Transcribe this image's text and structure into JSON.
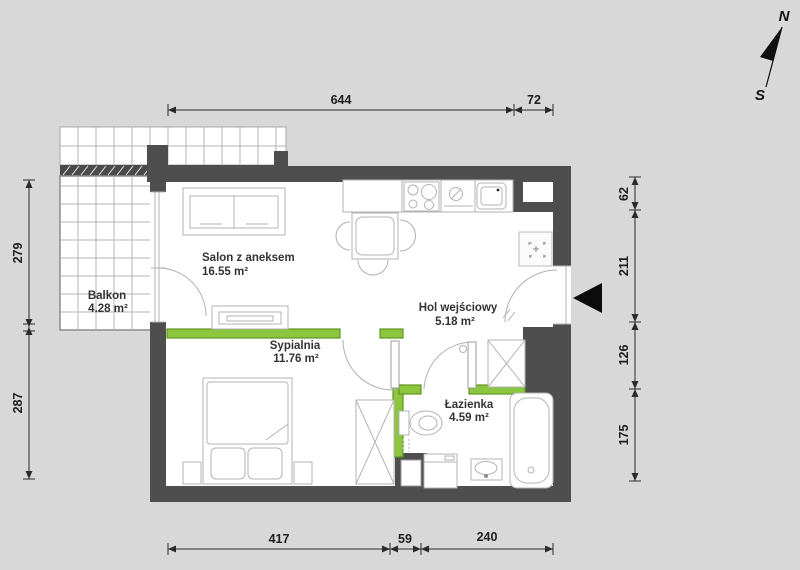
{
  "title": "Apartment floor plan",
  "compass": {
    "north": "N",
    "south": "S"
  },
  "rooms": [
    {
      "name": "Salon z aneksem",
      "area": "16.55 m²"
    },
    {
      "name": "Sypialnia",
      "area": "11.76 m²"
    },
    {
      "name": "Hol wejściowy",
      "area": "5.18 m²"
    },
    {
      "name": "Łazienka",
      "area": "4.59 m²"
    },
    {
      "name": "Balkon",
      "area": "4.28 m²"
    }
  ],
  "dimensions": {
    "top": [
      "644",
      "72"
    ],
    "bottom": [
      "417",
      "59",
      "240"
    ],
    "left": [
      "279",
      "287"
    ],
    "right": [
      "62",
      "211",
      "126",
      "175"
    ]
  },
  "colors": {
    "partition_green": "#8cc63f",
    "partition_green_border": "#60941f",
    "wall_gray": "#4e4e4e",
    "canvas_gray": "#d8d8d8",
    "floor_white": "#ffffff"
  }
}
